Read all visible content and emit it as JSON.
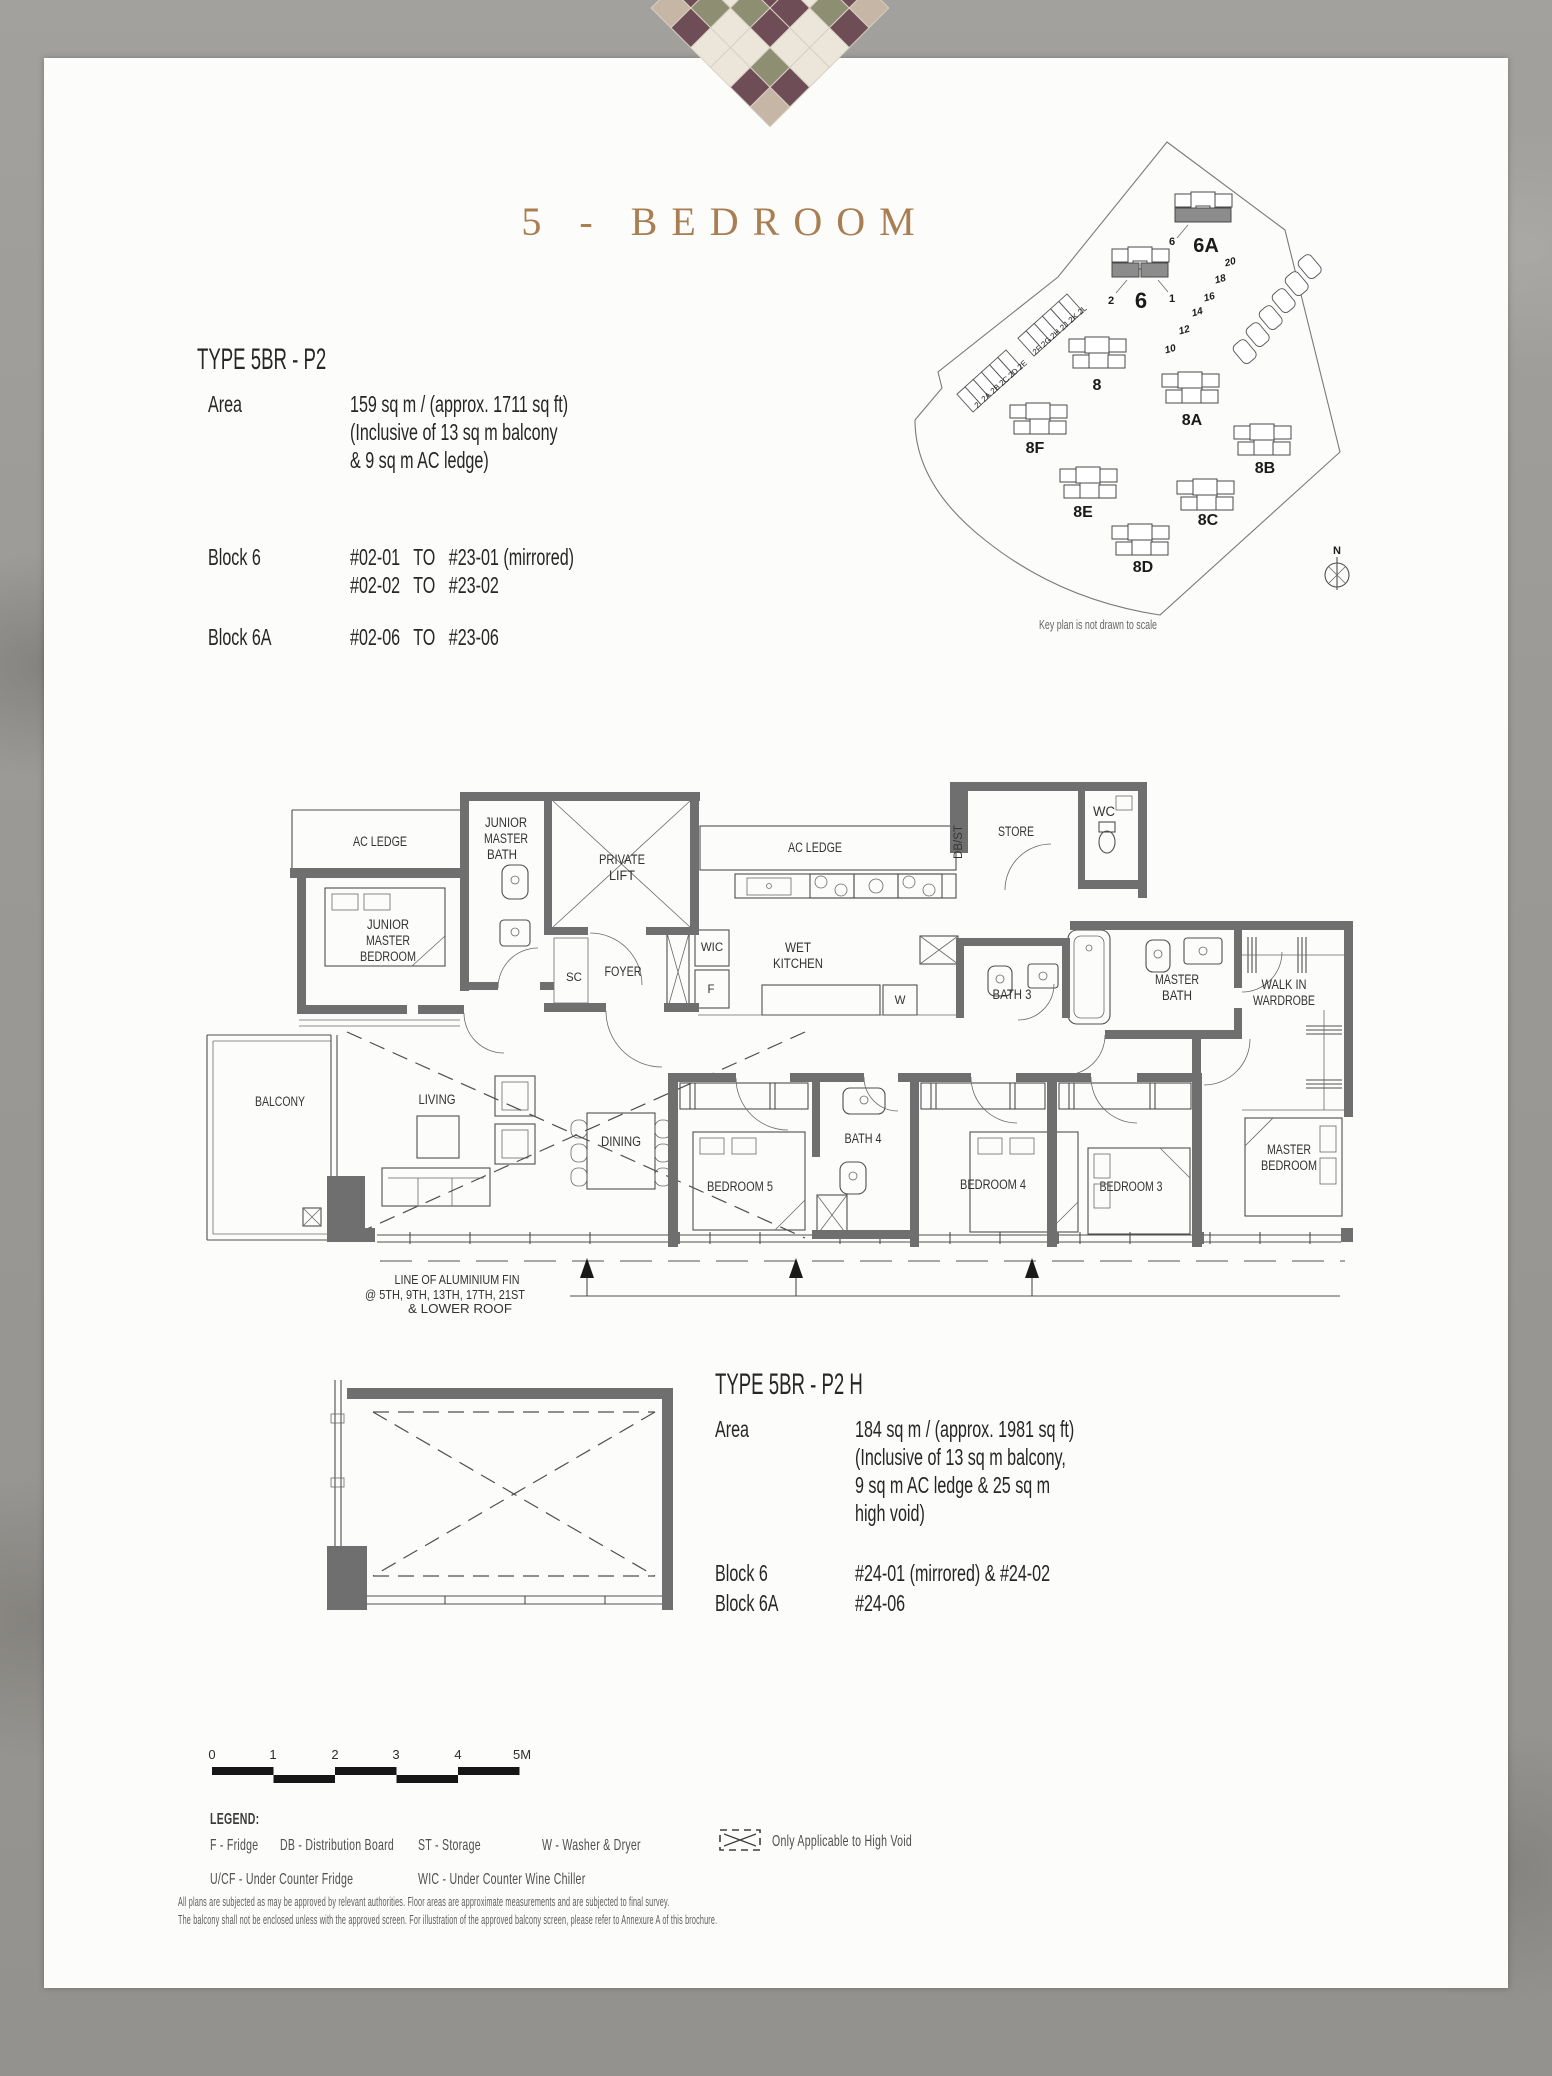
{
  "page": {
    "title": "5 - BEDROOM",
    "disclaimer1": "All plans are subjected as may be approved by relevant authorities. Floor areas are approximate measurements and are subjected to final survey.",
    "disclaimer2": "The balcony shall not be enclosed unless with the approved screen. For illustration of the approved balcony screen, please refer to Annexure A of this brochure."
  },
  "unit_p2": {
    "heading": "TYPE 5BR - P2",
    "area_label": "Area",
    "area_line1": "159 sq m / (approx. 1711 sq ft)",
    "area_line2": "(Inclusive of 13 sq m balcony",
    "area_line3": "& 9 sq m AC ledge)",
    "block6_label": "Block 6",
    "block6_line1": "#02-01   TO   #23-01 (mirrored)",
    "block6_line2": "#02-02   TO   #23-02",
    "block6a_label": "Block 6A",
    "block6a_line1": "#02-06   TO   #23-06"
  },
  "unit_p2h": {
    "heading": "TYPE 5BR - P2 H",
    "area_label": "Area",
    "area_line1": "184 sq m / (approx. 1981 sq ft)",
    "area_line2": "(Inclusive of 13 sq m balcony,",
    "area_line3": "9 sq m AC ledge & 25 sq m",
    "area_line4": "high void)",
    "block6_label": "Block 6",
    "block6_value": "#24-01 (mirrored) & #24-02",
    "block6a_label": "Block 6A",
    "block6a_value": "#24-06"
  },
  "keyplan": {
    "caption": "Key plan is not drawn to scale",
    "north": "N",
    "towers": {
      "b6a": "6A",
      "b6": "6",
      "b8": "8",
      "b8a": "8A",
      "b8b": "8B",
      "b8c": "8C",
      "b8d": "8D",
      "b8e": "8E",
      "b8f": "8F"
    },
    "units": {
      "u6": "6",
      "u2": "2",
      "u1": "1"
    },
    "townhouses": [
      "2",
      "2A",
      "2B",
      "2C",
      "2D",
      "2E",
      "2F",
      "2G",
      "2H",
      "2J",
      "2K",
      "2L"
    ],
    "landed": [
      "10",
      "12",
      "14",
      "16",
      "18",
      "20"
    ]
  },
  "floorplan": {
    "acledge1": "AC LEDGE",
    "jbath1": "JUNIOR",
    "jbath2": "MASTER",
    "jbath3": "BATH",
    "lift1": "PRIVATE",
    "lift2": "LIFT",
    "jbed1": "JUNIOR",
    "jbed2": "MASTER",
    "jbed3": "BEDROOM",
    "sc": "SC",
    "foyer": "FOYER",
    "wic": "WIC",
    "fridge": "F",
    "acledge2": "AC LEDGE",
    "wet1": "WET",
    "wet2": "KITCHEN",
    "washer": "W",
    "dbst": "DB/ST",
    "store": "STORE",
    "wc": "WC",
    "bath3": "BATH 3",
    "mbath1": "MASTER",
    "mbath2": "BATH",
    "wiw1": "WALK IN",
    "wiw2": "WARDROBE",
    "balcony": "BALCONY",
    "living": "LIVING",
    "dining": "DINING",
    "bed5": "BEDROOM 5",
    "bath4": "BATH 4",
    "bed4": "BEDROOM 4",
    "bed3": "BEDROOM 3",
    "mbed1": "MASTER",
    "mbed2": "BEDROOM",
    "fin1": "LINE OF ALUMINIUM FIN",
    "fin2": "@  5TH, 9TH, 13TH, 17TH, 21ST",
    "fin3": "&       LOWER ROOF"
  },
  "scalebar": {
    "ticks": [
      "0",
      "1",
      "2",
      "3",
      "4",
      "5M"
    ]
  },
  "legend": {
    "heading": "LEGEND:",
    "items_row1": [
      "F - Fridge",
      "DB - Distribution Board",
      "ST - Storage",
      "W - Washer & Dryer"
    ],
    "items_row2": [
      "U/CF - Under Counter Fridge",
      "WIC - Under Counter Wine Chiller"
    ],
    "highvoid": "Only Applicable to High Void"
  }
}
